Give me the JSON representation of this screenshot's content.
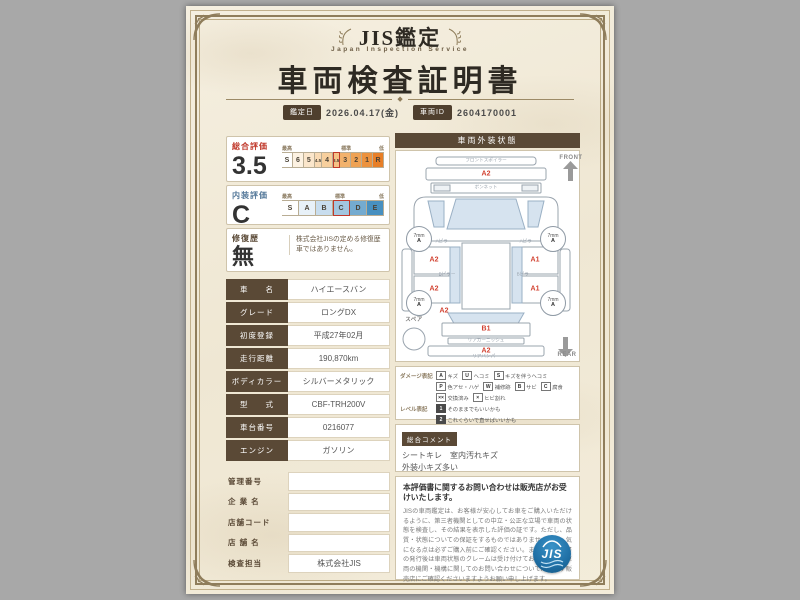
{
  "header": {
    "brand": "JIS鑑定",
    "brand_sub": "Japan Inspection Service",
    "title": "車両検査証明書",
    "date_label": "鑑定日",
    "date_value": "2026.04.17(金)",
    "id_label": "車両ID",
    "id_value": "2604170001"
  },
  "ratings": {
    "overall": {
      "label": "総合評価",
      "value": "3.5",
      "head": {
        "best": "最高",
        "standard": "標準",
        "low": "低"
      },
      "cells": [
        {
          "label": "S",
          "color": "#ffffff"
        },
        {
          "label": "6",
          "color": "#fdf2e2"
        },
        {
          "label": "5",
          "color": "#fbe6cb"
        },
        {
          "label": "4.5",
          "color": "#f9dab4",
          "narrow": true
        },
        {
          "label": "4",
          "color": "#f7cf9d"
        },
        {
          "label": "3.5",
          "color": "#f5c286",
          "narrow": true,
          "selected": true
        },
        {
          "label": "3",
          "color": "#f2b26c"
        },
        {
          "label": "2",
          "color": "#efa254"
        },
        {
          "label": "1",
          "color": "#ec923e"
        },
        {
          "label": "R",
          "color": "#e87f28"
        }
      ]
    },
    "interior": {
      "label": "内装評価",
      "value": "C",
      "head": {
        "best": "最高",
        "standard": "標準",
        "low": "低"
      },
      "cells": [
        {
          "label": "S",
          "color": "#ffffff"
        },
        {
          "label": "A",
          "color": "#e8f1f8"
        },
        {
          "label": "B",
          "color": "#c8ddee"
        },
        {
          "label": "C",
          "color": "#a2c6e0",
          "selected": true
        },
        {
          "label": "D",
          "color": "#74abd0"
        },
        {
          "label": "E",
          "color": "#4890c0"
        }
      ]
    },
    "repair": {
      "label": "修復歴",
      "value": "無",
      "note": "株式会社JISの定める修復歴車ではありません。"
    }
  },
  "vehicle_table": [
    {
      "label": "車　　名",
      "value": "ハイエースバン"
    },
    {
      "label": "グレード",
      "value": "ロングDX"
    },
    {
      "label": "初度登録",
      "value": "平成27年02月"
    },
    {
      "label": "走行距離",
      "value": "190,870km"
    },
    {
      "label": "ボディカラー",
      "value": "シルバーメタリック"
    },
    {
      "label": "型　　式",
      "value": "CBF-TRH200V"
    },
    {
      "label": "車台番号",
      "value": "0216077"
    },
    {
      "label": "エンジン",
      "value": "ガソリン"
    }
  ],
  "office_table": [
    {
      "label": "管理番号",
      "value": ""
    },
    {
      "label": "企 業 名",
      "value": ""
    },
    {
      "label": "店舗コード",
      "value": ""
    },
    {
      "label": "店 舗 名",
      "value": ""
    },
    {
      "label": "検査担当",
      "value": "株式会社JIS"
    }
  ],
  "exterior": {
    "title": "車両外装状態",
    "front_label": "FRONT",
    "rear_label": "REAR",
    "spare_label": "スペア",
    "tire": {
      "size": "7mm",
      "grade": "A"
    },
    "parts": {
      "front_spoiler": "フロントスポイラー",
      "bonnet": "ボンネット",
      "a_pillar": "Aピラー",
      "b_pillar": "Bピラー",
      "rear_garnish": "リアガーニッシュ",
      "rear_bumper": "リアバンパー"
    },
    "marks": {
      "front_bumper": "A2",
      "left_front_door": "A2",
      "left_slide_door": "A2",
      "left_quarter": "A2",
      "right_front_door": "A1",
      "right_slide_door": "A1",
      "rear_gate": "B1",
      "rear_bumper": "A2"
    }
  },
  "legend": {
    "damage_label": "ダメージ表記",
    "damage": [
      {
        "code": "A",
        "label": "キズ"
      },
      {
        "code": "U",
        "label": "ヘコミ"
      },
      {
        "code": "S",
        "label": "キズを伴うヘコミ"
      },
      {
        "code": "P",
        "label": "色アセ・ハゲ"
      },
      {
        "code": "W",
        "label": "補修跡",
        "dark": false
      },
      {
        "code": "B",
        "label": "サビ"
      },
      {
        "code": "C",
        "label": "腐食"
      },
      {
        "code": "××",
        "label": "交換済み"
      },
      {
        "code": "×",
        "label": "ヒビ割れ"
      }
    ],
    "level_label": "レベル表記",
    "levels": [
      {
        "code": "1",
        "label": "そのままでもいいかも",
        "dark": true
      },
      {
        "code": "2",
        "label": "これくらいで直せばいいかも",
        "dark": true
      },
      {
        "code": "3",
        "label": "修理したほうがいいかも",
        "dark": true
      },
      {
        "code": "4",
        "label": "このままでは無理かも",
        "dark": true
      }
    ]
  },
  "comment": {
    "label": "総合コメント",
    "lines": [
      "シートキレ　室内汚れキズ",
      "外装小キズ多い"
    ]
  },
  "footer": {
    "title": "本評価書に関するお問い合わせは販売店がお受けいたします。",
    "body": "JISの車両鑑定は、お客様が安心してお車をご購入いただけるように、第三者機関としての中立・公正な立場で車両の状態を検査し、その結果を表示した評価の証です。ただし、品質・状態についての保証をするものではありませんので、気になる点は必ずご購入前にご確認ください。また、本評価書の発行後は車両状態のクレームは受け付けておりません。車両の機関・機構に関してのお問い合わせについては、必ず販売店にご確認くださいますようお願い申し上げます。",
    "logo_text": "JIS"
  }
}
